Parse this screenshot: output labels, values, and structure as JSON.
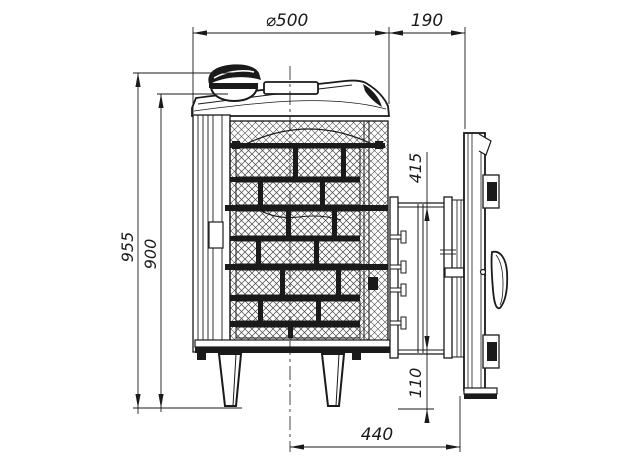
{
  "drawing": {
    "background": "#ffffff",
    "line_color": "#1a1a1a",
    "dimensions": {
      "diameter": "⌀500",
      "tunnel_length": "190",
      "overall_height": "955",
      "body_height": "900",
      "portal_height": "415",
      "portal_bottom_offset": "110",
      "center_to_door_face": "440"
    }
  }
}
